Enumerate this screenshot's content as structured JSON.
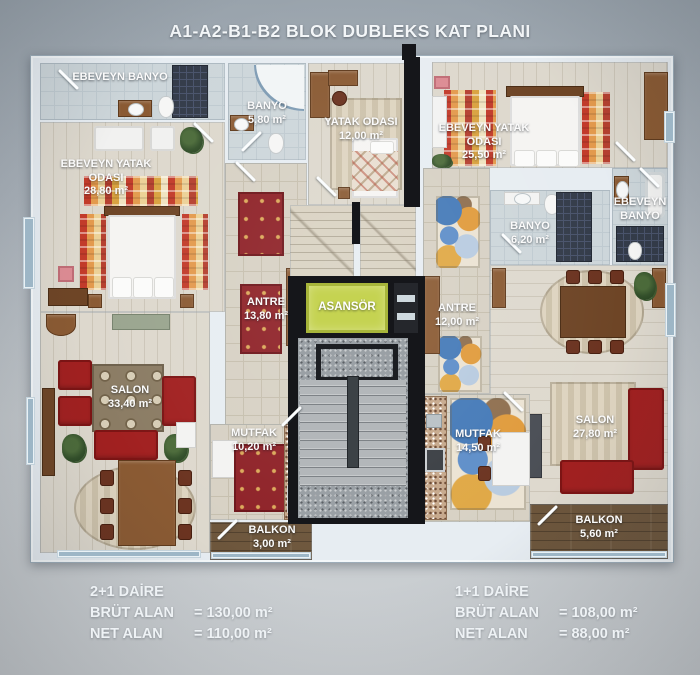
{
  "title": "A1-A2-B1-B2 BLOK DUBLEKS KAT PLANI",
  "rooms": {
    "ebeveyn_banyo_left": {
      "name": "EBEVEYN BANYO"
    },
    "banyo_left": {
      "name": "BANYO",
      "area": "5,80 m²"
    },
    "yatak_odasi": {
      "name": "YATAK ODASI",
      "area": "12,00 m²"
    },
    "ebeveyn_yatak_left": {
      "name": "EBEVEYN YATAK ODASI",
      "area": "28,80 m²"
    },
    "antre_left": {
      "name": "ANTRE",
      "area": "13,80 m²"
    },
    "salon_left": {
      "name": "SALON",
      "area": "33,40 m²"
    },
    "mutfak_left": {
      "name": "MUTFAK",
      "area": "10,20 m²"
    },
    "balkon_left": {
      "name": "BALKON",
      "area": "3,00 m²"
    },
    "asansor": {
      "name": "ASANSÖR"
    },
    "ebeveyn_yatak_right": {
      "name": "EBEVEYN YATAK ODASI",
      "area": "25,50 m²"
    },
    "ebeveyn_banyo_right": {
      "name": "EBEVEYN BANYO"
    },
    "banyo_right": {
      "name": "BANYO",
      "area": "6,20 m²"
    },
    "antre_right": {
      "name": "ANTRE",
      "area": "12,00 m²"
    },
    "salon_right": {
      "name": "SALON",
      "area": "27,80 m²"
    },
    "mutfak_right": {
      "name": "MUTFAK",
      "area": "14,50 m²"
    },
    "balkon_right": {
      "name": "BALKON",
      "area": "5,60 m²"
    }
  },
  "legend": {
    "left": {
      "title": "2+1 DAİRE",
      "rows": [
        {
          "label": "BRÜT ALAN",
          "value": "= 130,00 m²"
        },
        {
          "label": "NET ALAN",
          "value": "= 110,00 m²"
        }
      ]
    },
    "right": {
      "title": "1+1 DAİRE",
      "rows": [
        {
          "label": "BRÜT ALAN",
          "value": "= 108,00 m²"
        },
        {
          "label": "NET ALAN",
          "value": "= 88,00 m²"
        }
      ]
    }
  },
  "colors": {
    "elevator": "#c5d351",
    "sofa_red": "#a12020",
    "wall": "#e7edf2",
    "core_black": "#15161a",
    "background_top": "#99a3ac",
    "background_bottom": "#cdd1d4"
  }
}
